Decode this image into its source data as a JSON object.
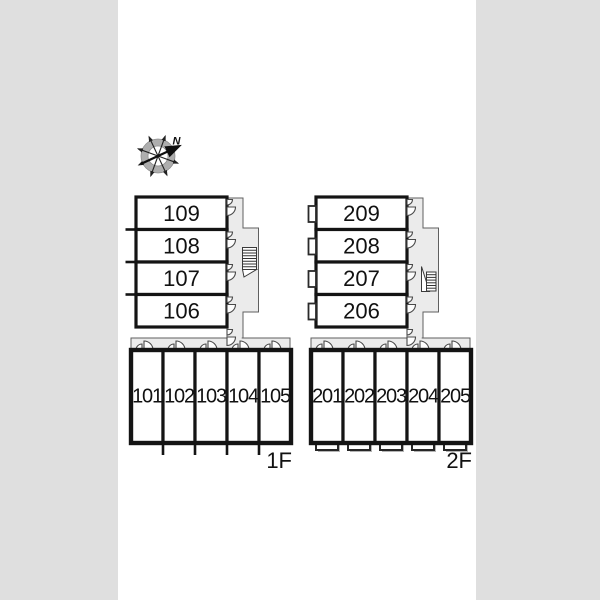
{
  "compass": {
    "north_label": "N"
  },
  "floors": [
    {
      "label": "1F",
      "upper_rooms": [
        "109",
        "108",
        "107",
        "106"
      ],
      "lower_rooms": [
        "101",
        "102",
        "103",
        "104",
        "105"
      ]
    },
    {
      "label": "2F",
      "upper_rooms": [
        "209",
        "208",
        "207",
        "206"
      ],
      "lower_rooms": [
        "201",
        "202",
        "203",
        "204",
        "205"
      ]
    }
  ],
  "colors": {
    "background": "#dfdfdf",
    "paper": "#ffffff",
    "corridor": "#ebebeb",
    "wall": "#141414",
    "compass_ring": "#aeaeae"
  }
}
